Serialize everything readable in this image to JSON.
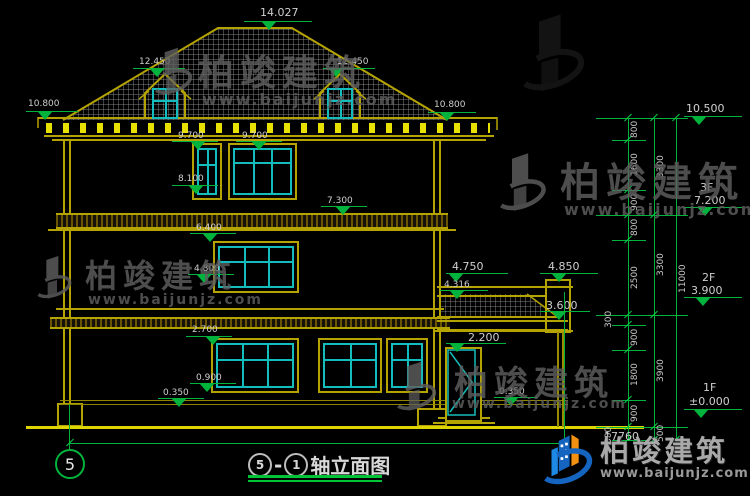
{
  "colors": {
    "annotation": "#00b33c",
    "building": "#b5a400",
    "glass": "#14bdbd",
    "ground": "#ded400",
    "roof_hatch": "#a5a5a5"
  },
  "watermark": {
    "brand": "柏竣建筑",
    "url": "www.baijunjz.com"
  },
  "footer_logo": {
    "brand": "柏竣建筑",
    "url": "www.baijunjz.com"
  },
  "drawing_title": {
    "axis_from": "5",
    "separator": "-",
    "axis_to": "1",
    "text": "轴立面图"
  },
  "axis_bubble": {
    "label": "5"
  },
  "bottom_dimension": {
    "total_width": "17760"
  },
  "levels": {
    "ridge": "14.027",
    "dormer_left": "12.450",
    "dormer_right": "12.450",
    "eave_left": "10.800",
    "eave_right": "10.800",
    "win3_top_a": "9.700",
    "win3_top_b": "9.700",
    "win3_sill": "8.100",
    "slab3": "7.300",
    "win2_top": "6.400",
    "win2_sill": "4.800",
    "porch_cap": "4.750",
    "porch_parapet": "4.850",
    "porch_slope": "4.316",
    "porch_eave": "3.600",
    "win1_top": "2.700",
    "door_top": "2.200",
    "win1_sill": "0.900",
    "plinth_left": "0.350",
    "porch_floor": "0.350"
  },
  "floor_levels": {
    "top": "10.500",
    "f3_label": "3F",
    "f3_value": "7.200",
    "f2_label": "2F",
    "f2_value": "3.900",
    "f1_label": "1F",
    "f1_value": "±0.000"
  },
  "dims": {
    "col1": [
      "800",
      "1600",
      "900",
      "800",
      "2500",
      "300",
      "900",
      "1800",
      "900",
      "500"
    ],
    "col2": [
      "3300",
      "3300",
      "3900",
      "500"
    ],
    "col3": [
      "11000"
    ]
  }
}
